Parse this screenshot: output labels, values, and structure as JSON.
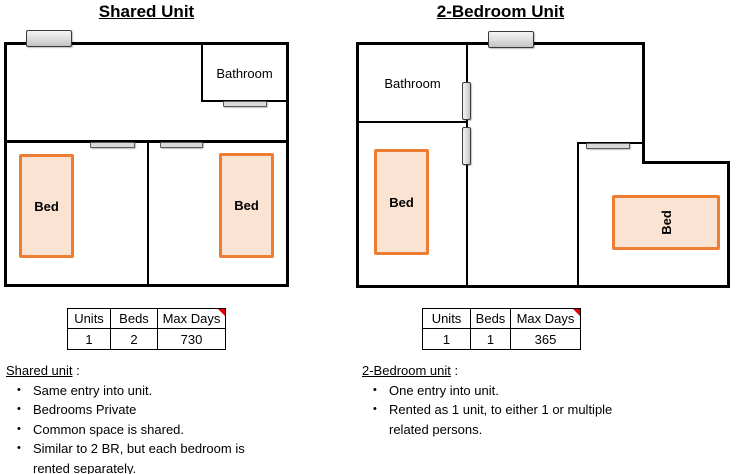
{
  "bullet_char": "•",
  "colors": {
    "wall": "#000000",
    "bed_fill": "#FBE3D3",
    "bed_border": "#ED7D31",
    "door_fill": "#D9D9D9",
    "comment_flag": "#E60000"
  },
  "left": {
    "title": "Shared Unit",
    "plan": {
      "bathroom_label": "Bathroom",
      "beds": [
        "Bed",
        "Bed"
      ]
    },
    "table": {
      "headers": [
        "Units",
        "Beds",
        "Max Days"
      ],
      "values": [
        "1",
        "2",
        "730"
      ]
    },
    "notes": {
      "heading": "Shared unit",
      "heading_suffix": " :",
      "bullets": [
        "Same entry into unit.",
        "Bedrooms Private",
        "Common space is shared.",
        "Similar to 2 BR, but each bedroom is\nrented separately."
      ]
    }
  },
  "right": {
    "title": "2-Bedroom Unit",
    "plan": {
      "bathroom_label": "Bathroom",
      "beds": [
        "Bed",
        "Bed"
      ]
    },
    "table": {
      "headers": [
        "Units",
        "Beds",
        "Max Days"
      ],
      "values": [
        "1",
        "1",
        "365"
      ]
    },
    "notes": {
      "heading": "2-Bedroom unit",
      "heading_suffix": " :",
      "bullets": [
        "One entry into unit.",
        "Rented as 1 unit, to either 1 or multiple\nrelated persons."
      ]
    }
  }
}
